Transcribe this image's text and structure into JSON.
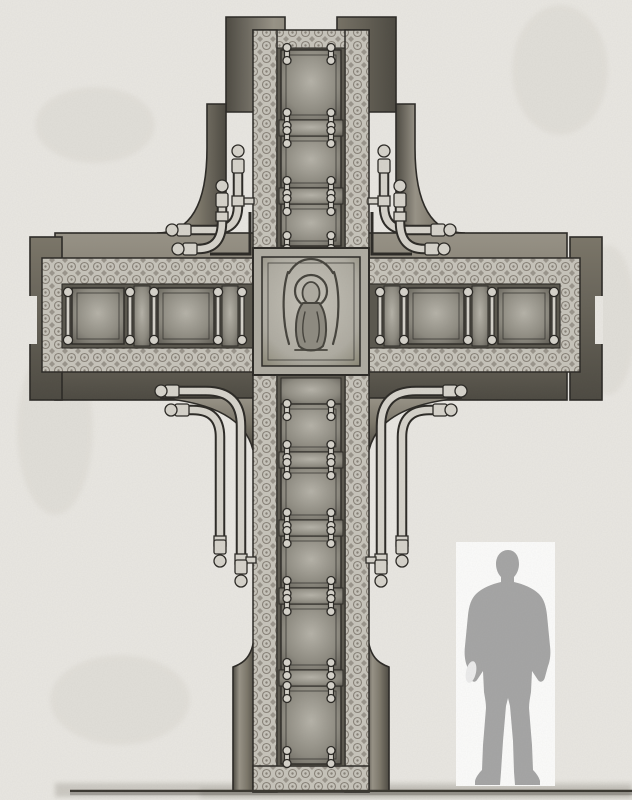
{
  "document": {
    "type": "pencil elevation drawing",
    "subject": "Design drawing of an ornamented memorial cross: paneled shaft and arms framed by decorative diaper-pattern borders, hinge-pin clamps joining the panels, paired pipe volutes at the four inner corners, a central square medallion with a Madonna relief, shown with a standing human silhouette for scale on a ground line"
  },
  "colors": {
    "paper": "#e9e7e2",
    "paper_shade": "#dcd9d2",
    "ink": "#2b2925",
    "slab_light": "#989387",
    "slab_mid": "#7b7669",
    "slab_dark": "#4c4941",
    "pattern_base": "#c7c4bb",
    "pattern_ink": "#888278",
    "strip": "#5a574e",
    "panel_light": "#b6b3a9",
    "panel_mid": "#8e8b81",
    "panel_dark": "#5e5b53",
    "metal": "#d6d3cb",
    "medallion_base": "#afaca2",
    "medallion_light": "#c7c4ba",
    "medallion_dark": "#84816f",
    "relief_ink": "#45433c",
    "silhouette": "#a5a5a5",
    "card": "#fcfcfb",
    "ground": "#3a3730",
    "smudge": "#8a867b"
  },
  "structure": {
    "cross": {
      "arm_panels_left": 3,
      "arm_panels_right": 3,
      "shaft_panels_above_crossing": 3,
      "shaft_panels_below_crossing": 5,
      "corner_pipe_groups": 4,
      "pipes_per_corner": 2,
      "central_medallion": "Madonna relief in square frame"
    },
    "scale_figure": {
      "kind": "standing man silhouette on white card",
      "purpose": "human scale reference"
    }
  }
}
